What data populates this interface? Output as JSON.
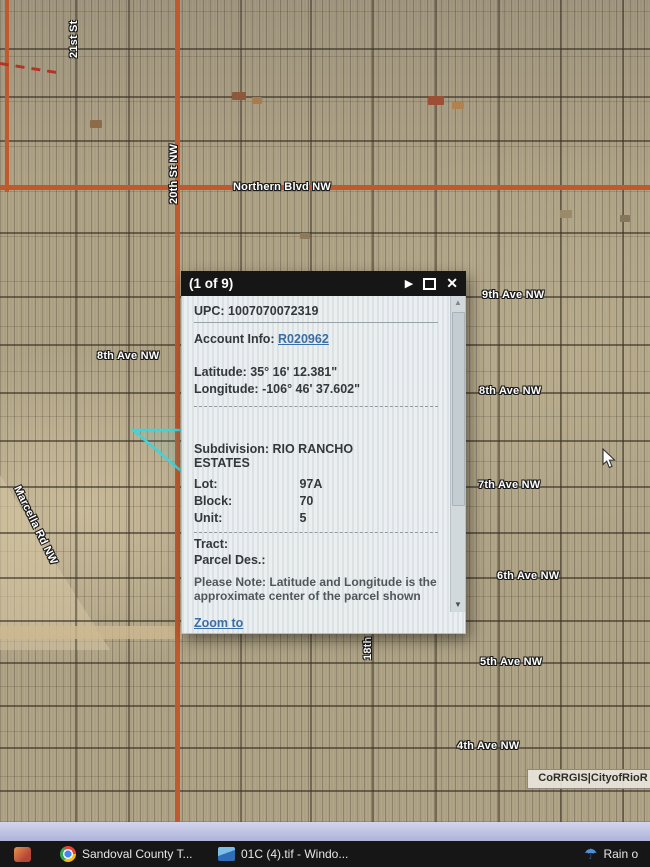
{
  "map": {
    "attribution": "CoRRGIS|CityofRioR",
    "streets": [
      {
        "text": "21st St"
      },
      {
        "text": "20th St NW"
      },
      {
        "text": "Northern Blvd NW"
      },
      {
        "text": "8th Ave NW"
      },
      {
        "text": "9th Ave NW"
      },
      {
        "text": "8th Ave NW"
      },
      {
        "text": "7th Ave NW"
      },
      {
        "text": "6th Ave NW"
      },
      {
        "text": "5th Ave NW"
      },
      {
        "text": "4th Ave NW"
      },
      {
        "text": "Marcella Rd NW"
      },
      {
        "text": "18th"
      }
    ],
    "colors": {
      "terrain": "#aca083",
      "road_orange": "#c05a2e",
      "parcel_highlight": "#3fd4da"
    }
  },
  "popup": {
    "title": "(1 of 9)",
    "icons": {
      "next": "play-arrow",
      "maximize": "square-outline",
      "close": "x",
      "scroll_up": "triangle-up",
      "scroll_down": "triangle-down"
    },
    "upc_label": "UPC:",
    "upc_value": "1007070072319",
    "account_label": "Account Info:",
    "account_link": "R020962",
    "latitude_label": "Latitude:",
    "latitude_value": "35° 16' 12.381\"",
    "longitude_label": "Longitude:",
    "longitude_value": "-106° 46' 37.602\"",
    "subdivision_label": "Subdivision:",
    "subdivision_value": "RIO RANCHO ESTATES",
    "lot_label": "Lot:",
    "lot_value": "97A",
    "block_label": "Block:",
    "block_value": "70",
    "unit_label": "Unit:",
    "unit_value": "5",
    "tract_label": "Tract:",
    "parcel_des_label": "Parcel Des.:",
    "note": "Please Note: Latitude and Longitude is the approximate center of the parcel shown",
    "zoom_to": "Zoom to"
  },
  "taskbar": {
    "apps": [
      {
        "label": "Sandoval County T...",
        "icon": "chrome-icon"
      },
      {
        "label": "01C (4).tif - Windo...",
        "icon": "photo-viewer-icon"
      }
    ],
    "weather": {
      "label": "Rain o",
      "icon": "umbrella-icon"
    }
  }
}
